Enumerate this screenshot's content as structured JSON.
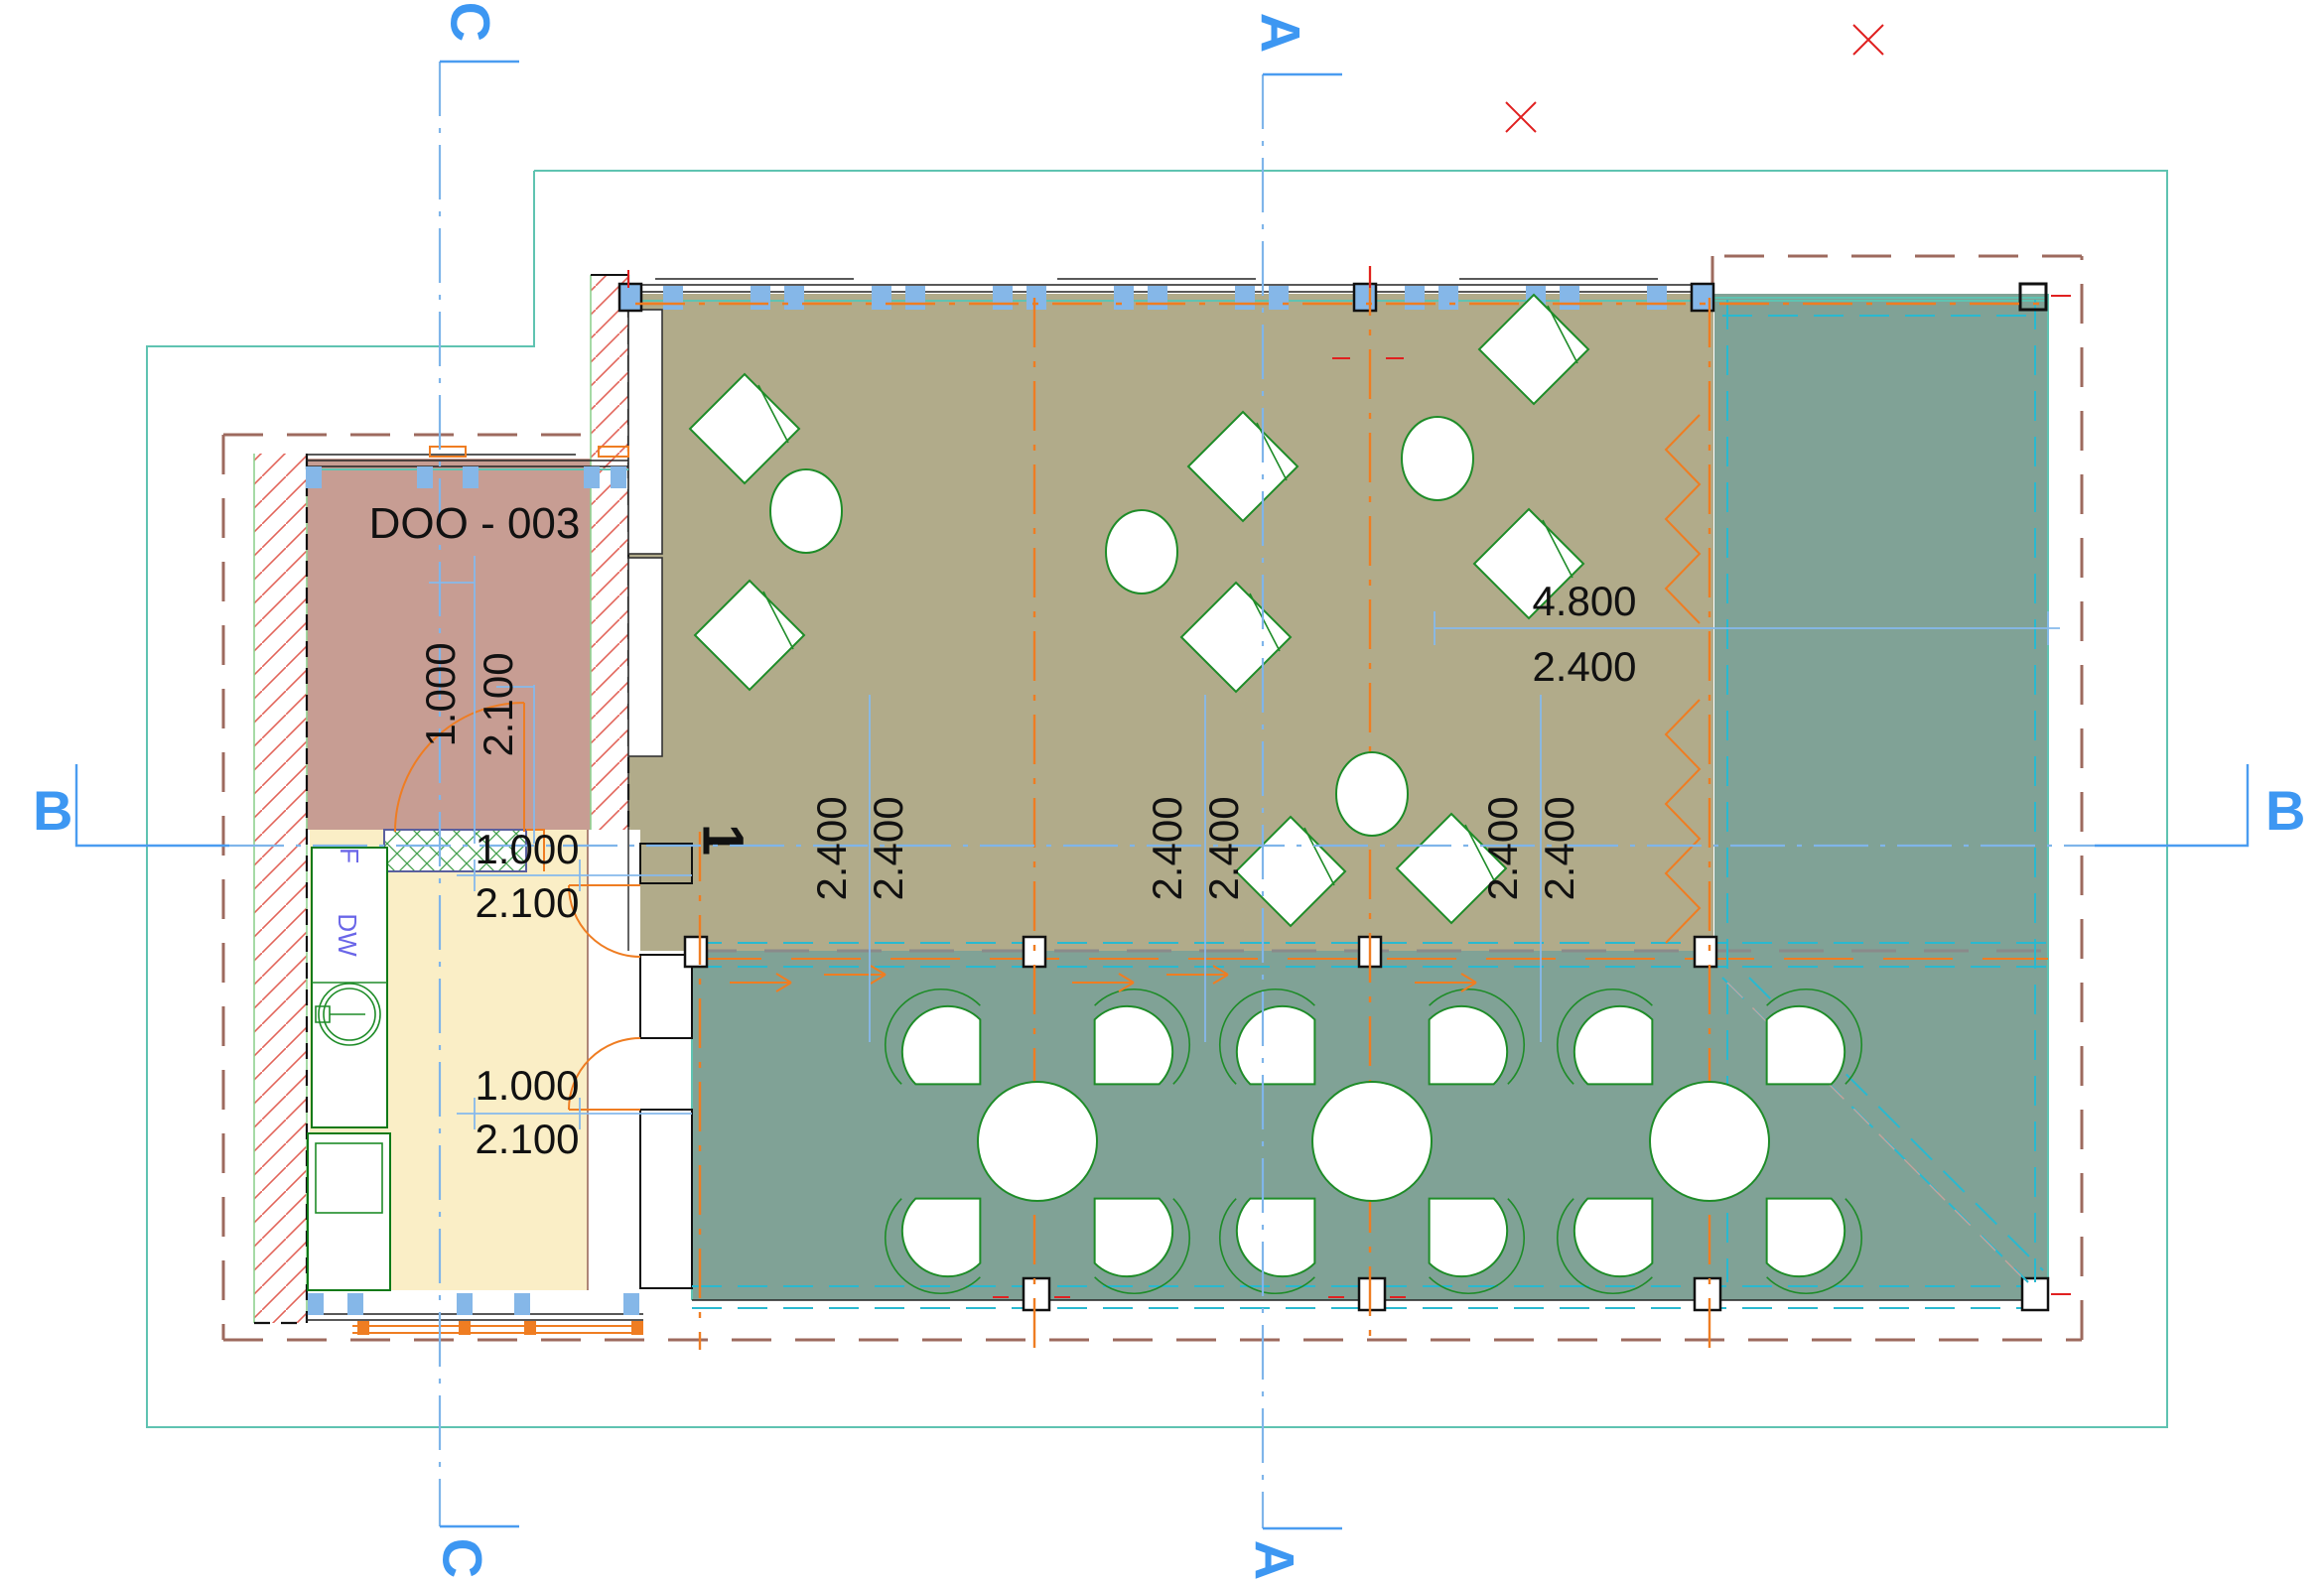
{
  "drawing": {
    "type": "architectural-floor-plan",
    "room": {
      "label": "DOO - 003"
    },
    "appliances": {
      "fridge": "F",
      "dishwasher": "DW"
    },
    "doors": {
      "number": "1",
      "width": "1.000",
      "height": "2.100"
    },
    "dims": {
      "module": "2.400",
      "span": "4.800",
      "span_half": "2.400"
    },
    "sections": {
      "a": "A",
      "b": "B",
      "c": "C"
    },
    "colors": {
      "dining_fill": "#b1ab8a",
      "doo_room_fill": "#c79d93",
      "kitchen_fill": "#faeec6",
      "terrace_fill": "#80a296",
      "grid_orange": "#ef7d22",
      "section_blue": "#3d97f2",
      "dimension_blue": "#86b9ec",
      "demolition_boundary_red": "#9d6a5e",
      "site_boundary_teal": "#5fc3b1",
      "furniture_green": "#1e8c28",
      "window_post_blue": "#85b7e8",
      "deck_cyan_dash": "#29b9d0",
      "marker_red": "#e02020",
      "appliance_label_purple": "#6a66e8"
    }
  }
}
